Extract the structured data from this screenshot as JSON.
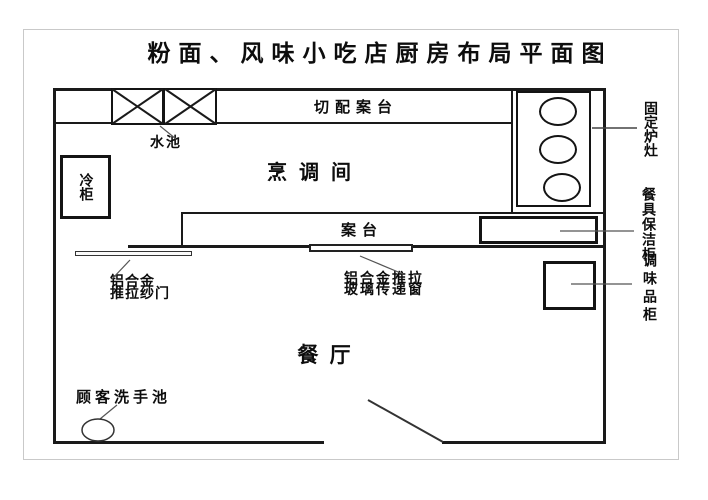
{
  "title": "粉面、风味小吃店厨房布局平面图",
  "rooms": {
    "cooking_room": "烹调间",
    "dining_room": "餐  厅"
  },
  "labels": {
    "prep_counter": "切配案台",
    "sink": "水池",
    "cold_cabinet": "冷柜",
    "counter": "案台",
    "fixed_stove": "固定炉灶",
    "tableware_clean_cabinet": "餐具保洁柜",
    "condiment_cabinet": "调味品柜",
    "screen_door_line1": "铝合金",
    "screen_door_line2": "推拉纱门",
    "pass_window_line1": "铝合金推拉",
    "pass_window_line2": "玻璃传递窗",
    "customer_wash_basin": "顾客洗手池"
  },
  "colors": {
    "line": "#1a1a1a",
    "leader": "#555555",
    "background": "#ffffff",
    "frame": "#c9c9c9"
  }
}
